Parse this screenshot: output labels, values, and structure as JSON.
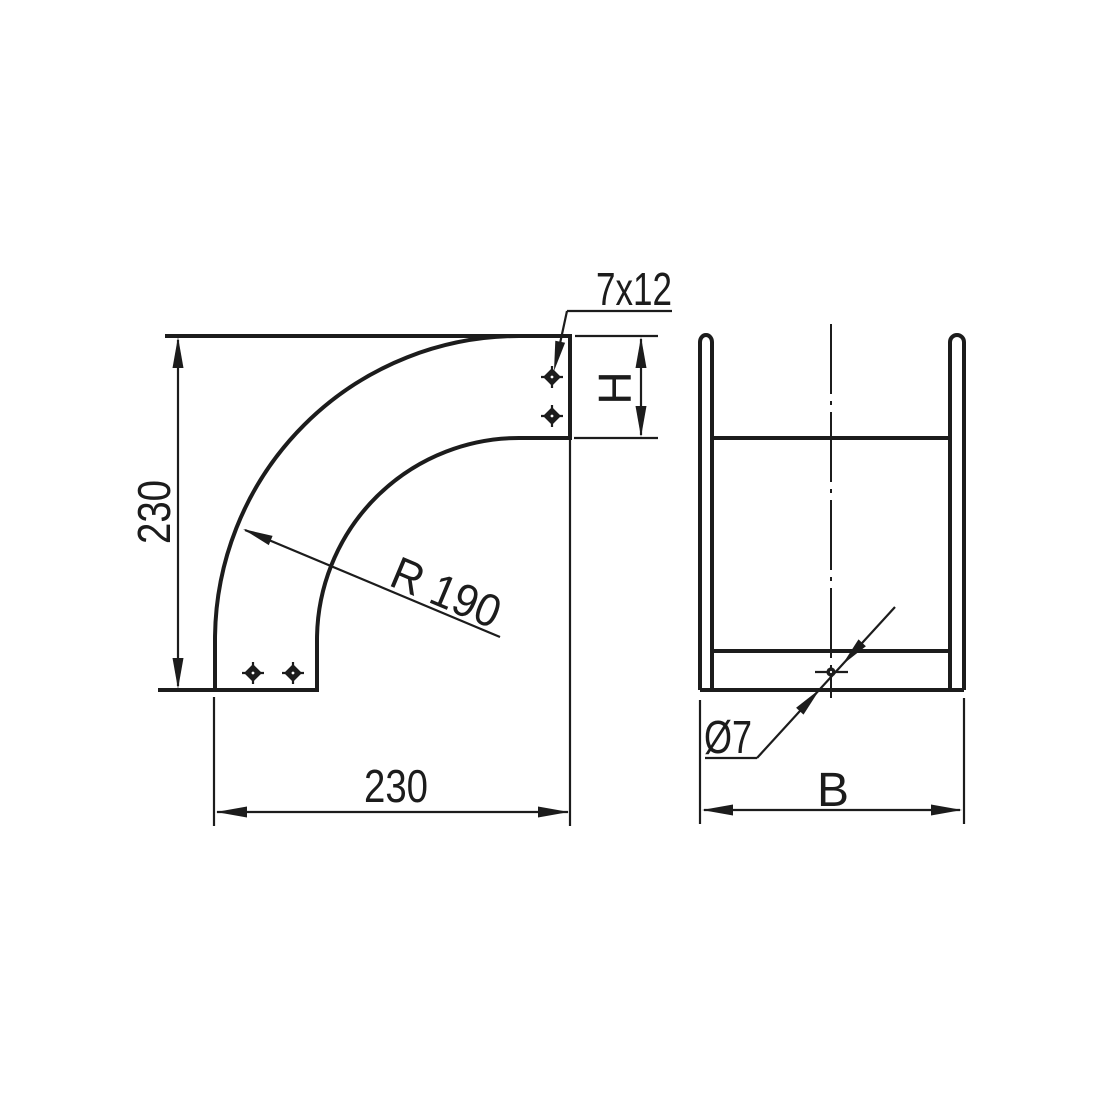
{
  "front_view": {
    "slot_callout": "7x12",
    "vertical_dimension": "230",
    "horizontal_dimension": "230",
    "bend_radius": "R 190",
    "end_height": "H"
  },
  "side_view": {
    "hole_diameter": "Ø7",
    "width": "B"
  },
  "style": {
    "line_color": "#1c1c1c",
    "background": "#ffffff"
  }
}
